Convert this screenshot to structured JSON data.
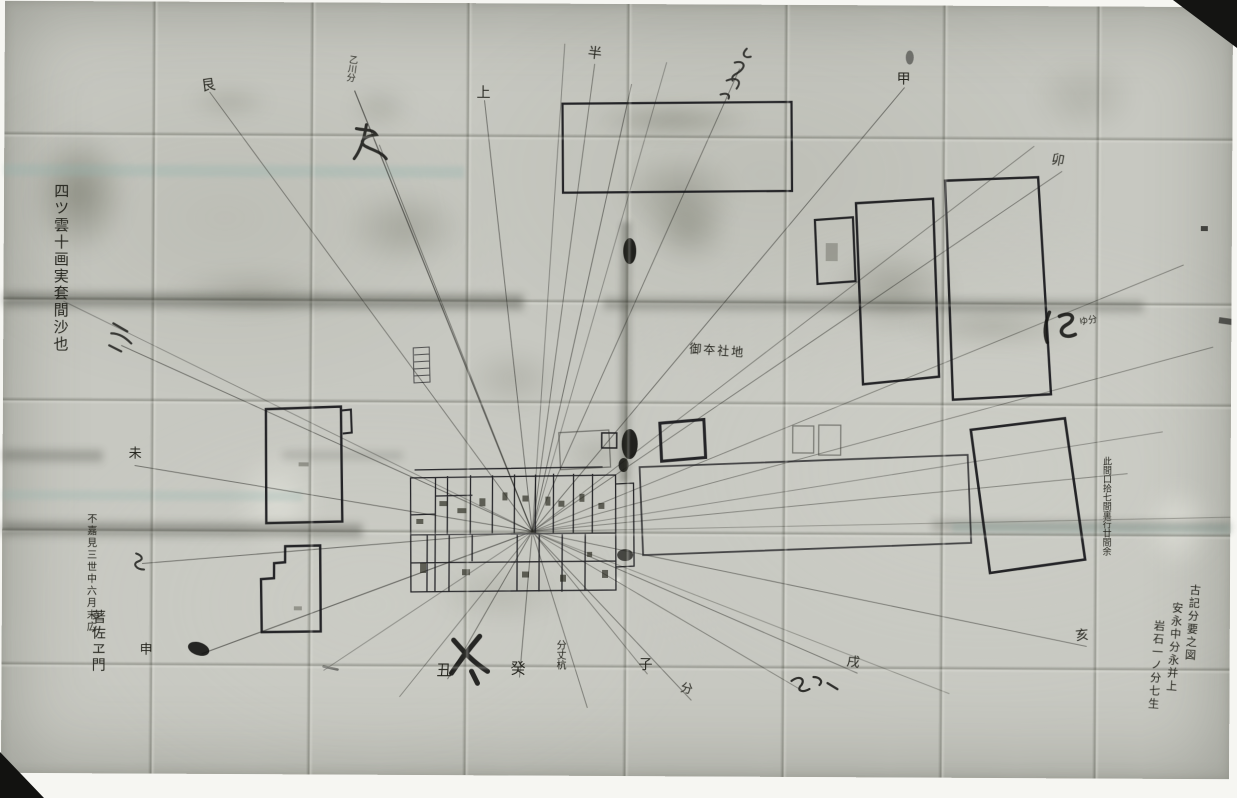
{
  "meta": {
    "title": "Black-and-white photograph of an old folded hand-drawn Japanese survey map",
    "description": "Creased paper plan with a central building compound, radiating sight lines to compass bearing marks, outlined land parcels and brush calligraphy annotations"
  },
  "colors": {
    "photo_background": "#f6f6f2",
    "paper": "#c7c8c1",
    "ink": "#16161a",
    "fold_shadow": "#3c3e34",
    "corner_dark": "#141412",
    "tint_band": "#8fb3ad"
  },
  "annotations": [
    {
      "id": "compass-ne",
      "text": "艮"
    },
    {
      "id": "compass-top-1",
      "text": "上"
    },
    {
      "id": "compass-top-2",
      "text": "半"
    },
    {
      "id": "compass-top-3",
      "text": "甲"
    },
    {
      "id": "compass-right-1",
      "text": "卯"
    },
    {
      "id": "compass-left-1",
      "text": "未"
    },
    {
      "id": "compass-left-2",
      "text": "申"
    },
    {
      "id": "compass-bottom-1",
      "text": "丑"
    },
    {
      "id": "compass-bottom-2",
      "text": "癸"
    },
    {
      "id": "compass-bottom-3",
      "text": "子"
    },
    {
      "id": "compass-bottom-4",
      "text": "分"
    },
    {
      "id": "compass-bottom-5",
      "text": "戌"
    },
    {
      "id": "compass-bottom-6",
      "text": "亥"
    },
    {
      "id": "calligraphy-left-column",
      "text": "四ツ雲十画実套間沙也"
    },
    {
      "id": "calligraphy-bottom-left-1",
      "text": "不嘉見三世中六月末広"
    },
    {
      "id": "calligraphy-bottom-left-2",
      "text": "著佐ヱ門"
    },
    {
      "id": "calligraphy-bottom-right-1",
      "text": "古記分要之図"
    },
    {
      "id": "calligraphy-bottom-right-2",
      "text": "安永中分永并上"
    },
    {
      "id": "calligraphy-bottom-right-3",
      "text": "岩石一ノ分七生"
    },
    {
      "id": "note-right-small-column",
      "text": "此間口拾七間裏行廿間余"
    },
    {
      "id": "note-center",
      "text": "御夲社地"
    },
    {
      "id": "note-top-column",
      "text": "乙川分"
    },
    {
      "id": "note-bottom-column",
      "text": "分丈杭"
    },
    {
      "id": "note-right-bold-small",
      "text": "ゆ分"
    }
  ]
}
